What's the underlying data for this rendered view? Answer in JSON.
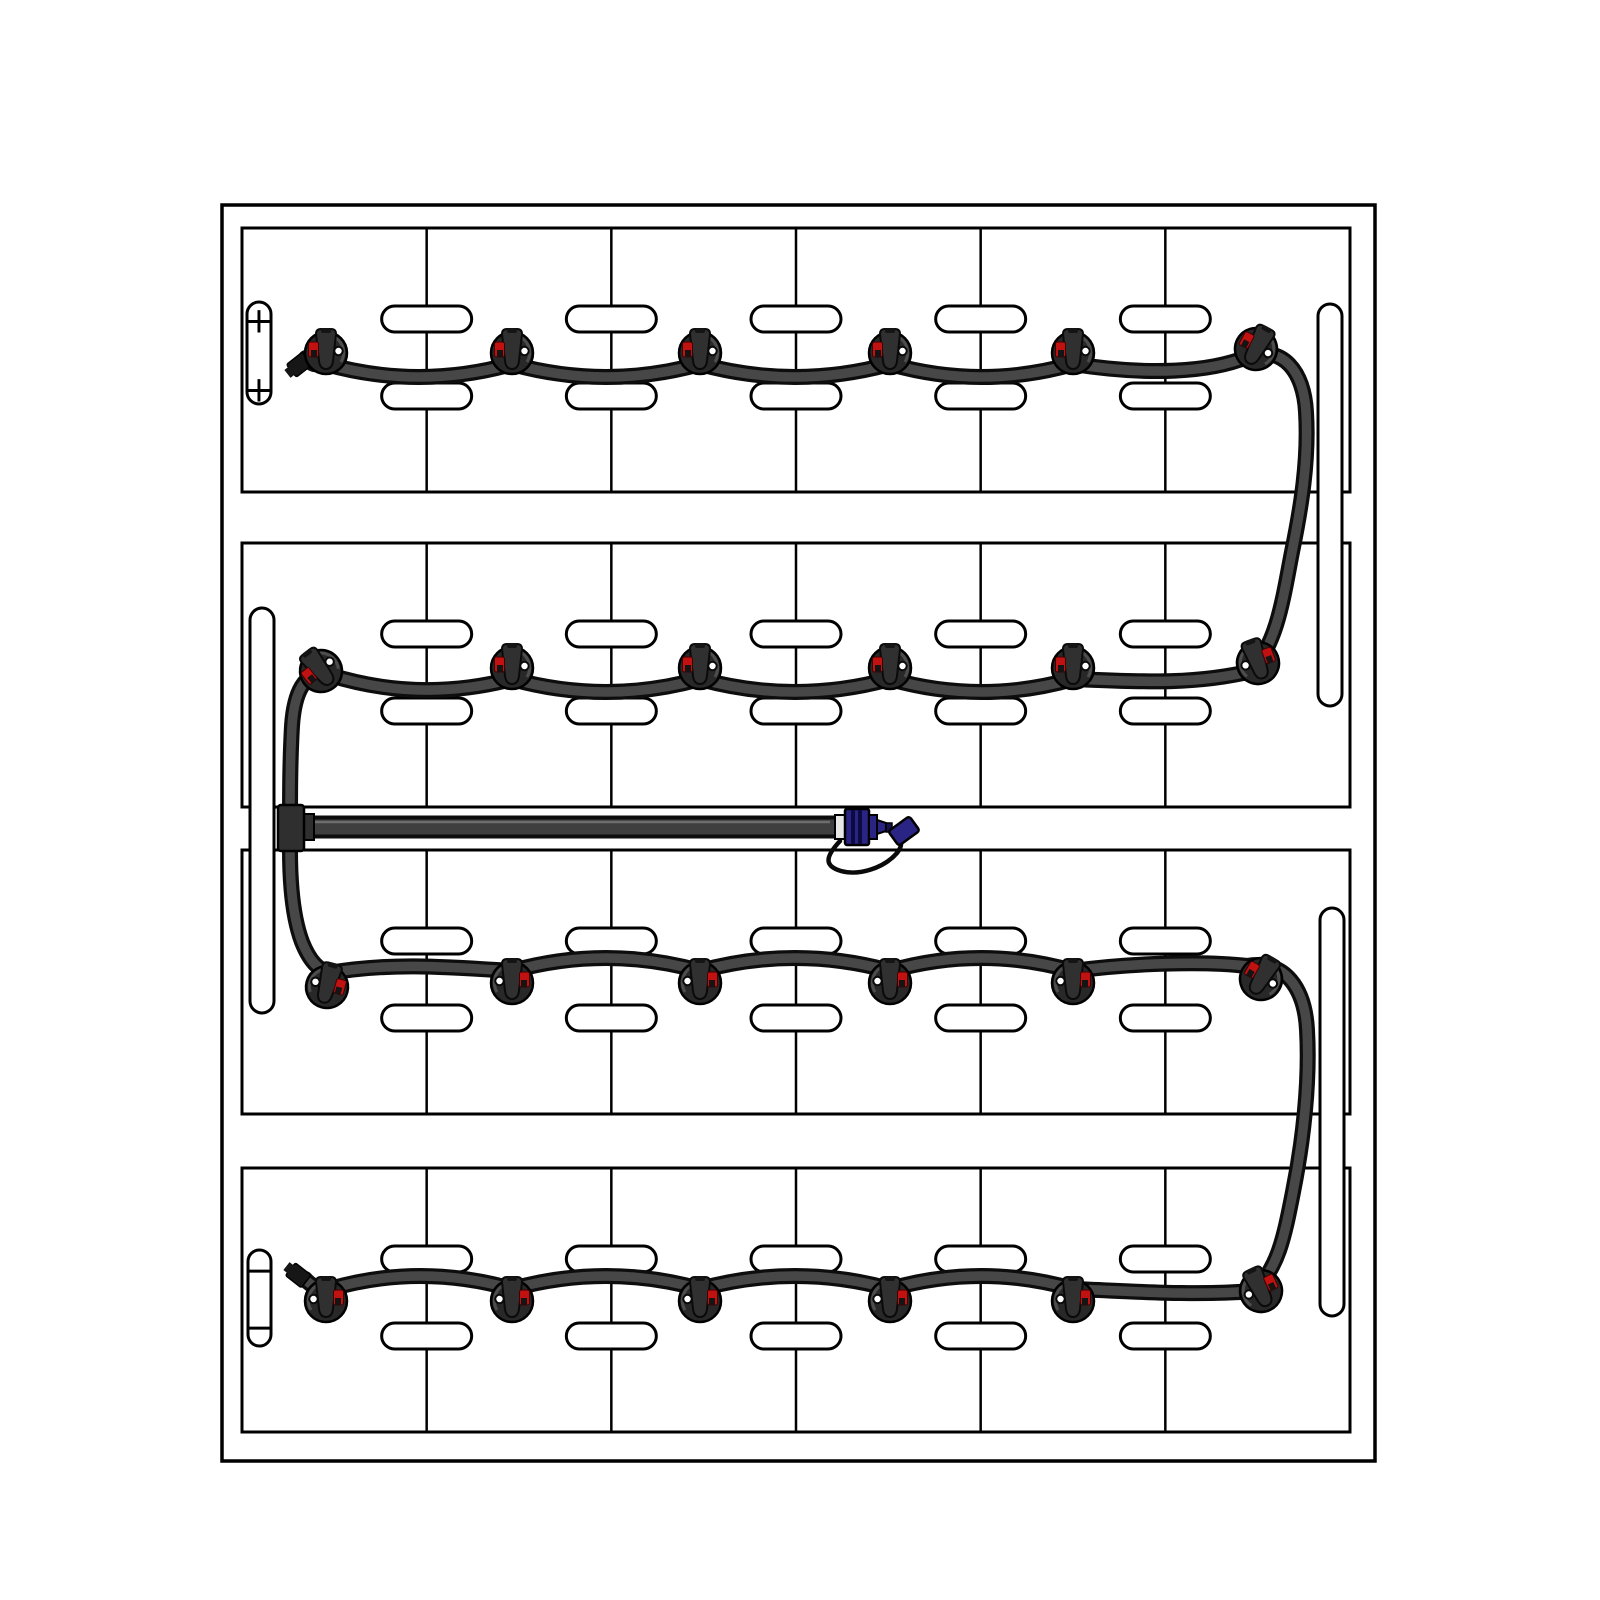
{
  "meta": {
    "description": "Battery watering system kit layout diagram",
    "rows": 4,
    "cells_per_row": 6,
    "caps_total": 24
  },
  "palette": {
    "background": "#ffffff",
    "line": "#000000",
    "tube_casing": "#0d0d0d",
    "tube_fill": "#474747",
    "main_tube_fill": "#3f3f3f",
    "tube_highlight": "#6e6e6e",
    "cap_body": "#282828",
    "cap_lid": "#303030",
    "cap_dark": "#141414",
    "indicator_red": "#c11212",
    "dot_white": "#ffffff",
    "connector_blue": "#2a2584",
    "rib_blue": "#0c0a3e",
    "collar_gray": "#e8e8e8",
    "fitting_gray": "#2f2f2f"
  },
  "enclosure": {
    "x": 222,
    "y": 205,
    "w": 1153,
    "h": 1256
  },
  "trays": {
    "x": 242,
    "w": 1108,
    "h": 264,
    "tops": [
      228,
      543,
      850,
      1168
    ],
    "cells": 6
  },
  "vents": {
    "w": 90,
    "h": 26,
    "rx": 13,
    "top_cy": 91,
    "bottom_cy": 168
  },
  "side_channels": [
    {
      "x": 250,
      "y": 608,
      "w": 24,
      "h": 405
    },
    {
      "x": 1318,
      "y": 304,
      "w": 24,
      "h": 402
    },
    {
      "x": 1320,
      "y": 908,
      "w": 24,
      "h": 408
    }
  ],
  "terminals": {
    "positive": {
      "symbol": "+",
      "pill": {
        "x": 247,
        "y": 302,
        "w": 24,
        "h": 102
      },
      "marks_y": [
        321,
        390
      ]
    },
    "negative": {
      "symbol": "−",
      "pill": {
        "x": 248,
        "y": 1250,
        "w": 23,
        "h": 96
      },
      "marks_y": [
        1271,
        1328
      ]
    }
  },
  "caps": {
    "r": 21,
    "xs": [
      326,
      512,
      700,
      890,
      1073,
      1258
    ],
    "rows": [
      {
        "cy": 353,
        "flip": false,
        "overrides": {
          "5": {
            "x": 1256,
            "y": 349,
            "rot": 28
          }
        }
      },
      {
        "cy": 668,
        "flip": false,
        "overrides": {
          "0": {
            "x": 321,
            "y": 671,
            "rot": -38
          },
          "5": {
            "x": 1258,
            "y": 663,
            "rot": -20,
            "flip": true
          }
        }
      },
      {
        "cy": 983,
        "flip": true,
        "overrides": {
          "0": {
            "x": 327,
            "y": 987,
            "rot": 15
          },
          "5": {
            "x": 1261,
            "y": 979,
            "rot": 30,
            "flip": false
          }
        }
      },
      {
        "cy": 1301,
        "flip": true,
        "overrides": {
          "5": {
            "x": 1261,
            "y": 1291,
            "rot": -25
          }
        }
      }
    ]
  },
  "tube": {
    "casing_w": 16,
    "inner_w": 9.5,
    "path": "M 306,358 C 313,367 319,364 326,364 Q 419,390 512,364 Q 606,390 700,364 Q 795,390 890,364 Q 981,390 1073,364 C 1150,376 1210,372 1247,357 C 1283,344 1304,372 1306,412 C 1309,460 1301,508 1292,552 C 1283,598 1278,640 1252,671 C 1190,686 1130,681 1073,679 Q 981,705 890,679 Q 795,705 700,679 Q 606,705 512,679 Q 420,703 330,675 C 303,668 294,696 292,726 C 290,762 290,794 290,830 L 290,850 C 290,886 293,918 302,942 C 310,962 319,970 329,973 C 392,962 450,967 512,971 Q 606,945 700,971 Q 795,945 890,971 Q 981,945 1073,971 C 1130,963 1205,961 1247,966 C 1286,959 1305,990 1307,1030 C 1310,1082 1303,1142 1293,1192 C 1284,1238 1278,1268 1254,1291 C 1192,1296 1130,1291 1073,1289 Q 981,1263 890,1289 Q 795,1263 700,1289 Q 606,1263 512,1289 Q 420,1263 330,1289 C 321,1291 311,1286 305,1279"
  },
  "fill_tube": {
    "y": 827,
    "x1": 300,
    "x2": 836,
    "casing_w": 23,
    "inner_w": 15,
    "tee": {
      "x": 278,
      "y": 805,
      "w": 26,
      "h": 46
    },
    "stub": {
      "x": 302,
      "y": 814,
      "w": 12,
      "h": 26
    }
  },
  "elbows": [
    {
      "x": 304,
      "y": 361,
      "rot": -38
    },
    {
      "x": 303,
      "y": 1279,
      "rot": 38
    }
  ],
  "connector": {
    "collar": {
      "x": 835,
      "y": 815,
      "w": 10,
      "h": 24
    },
    "body": {
      "x": 845,
      "y": 809,
      "w": 24,
      "h": 36
    },
    "ribs_x": [
      851,
      858
    ],
    "rib_w": 4,
    "step": {
      "x": 869,
      "y": 815,
      "w": 8,
      "h": 24
    },
    "taper": "877,820 886,823 886,831 877,834",
    "tip": {
      "x": 886,
      "y": 823,
      "w": 6,
      "h": 9
    },
    "dust_cap": {
      "cx": 904,
      "cy": 831,
      "rot": -36,
      "w": 26,
      "h": 18
    },
    "lanyard": "M 840,841 C 825,857 824,866 841,871 C 859,876 884,868 897,853 C 901,848 902,843 900,839"
  }
}
